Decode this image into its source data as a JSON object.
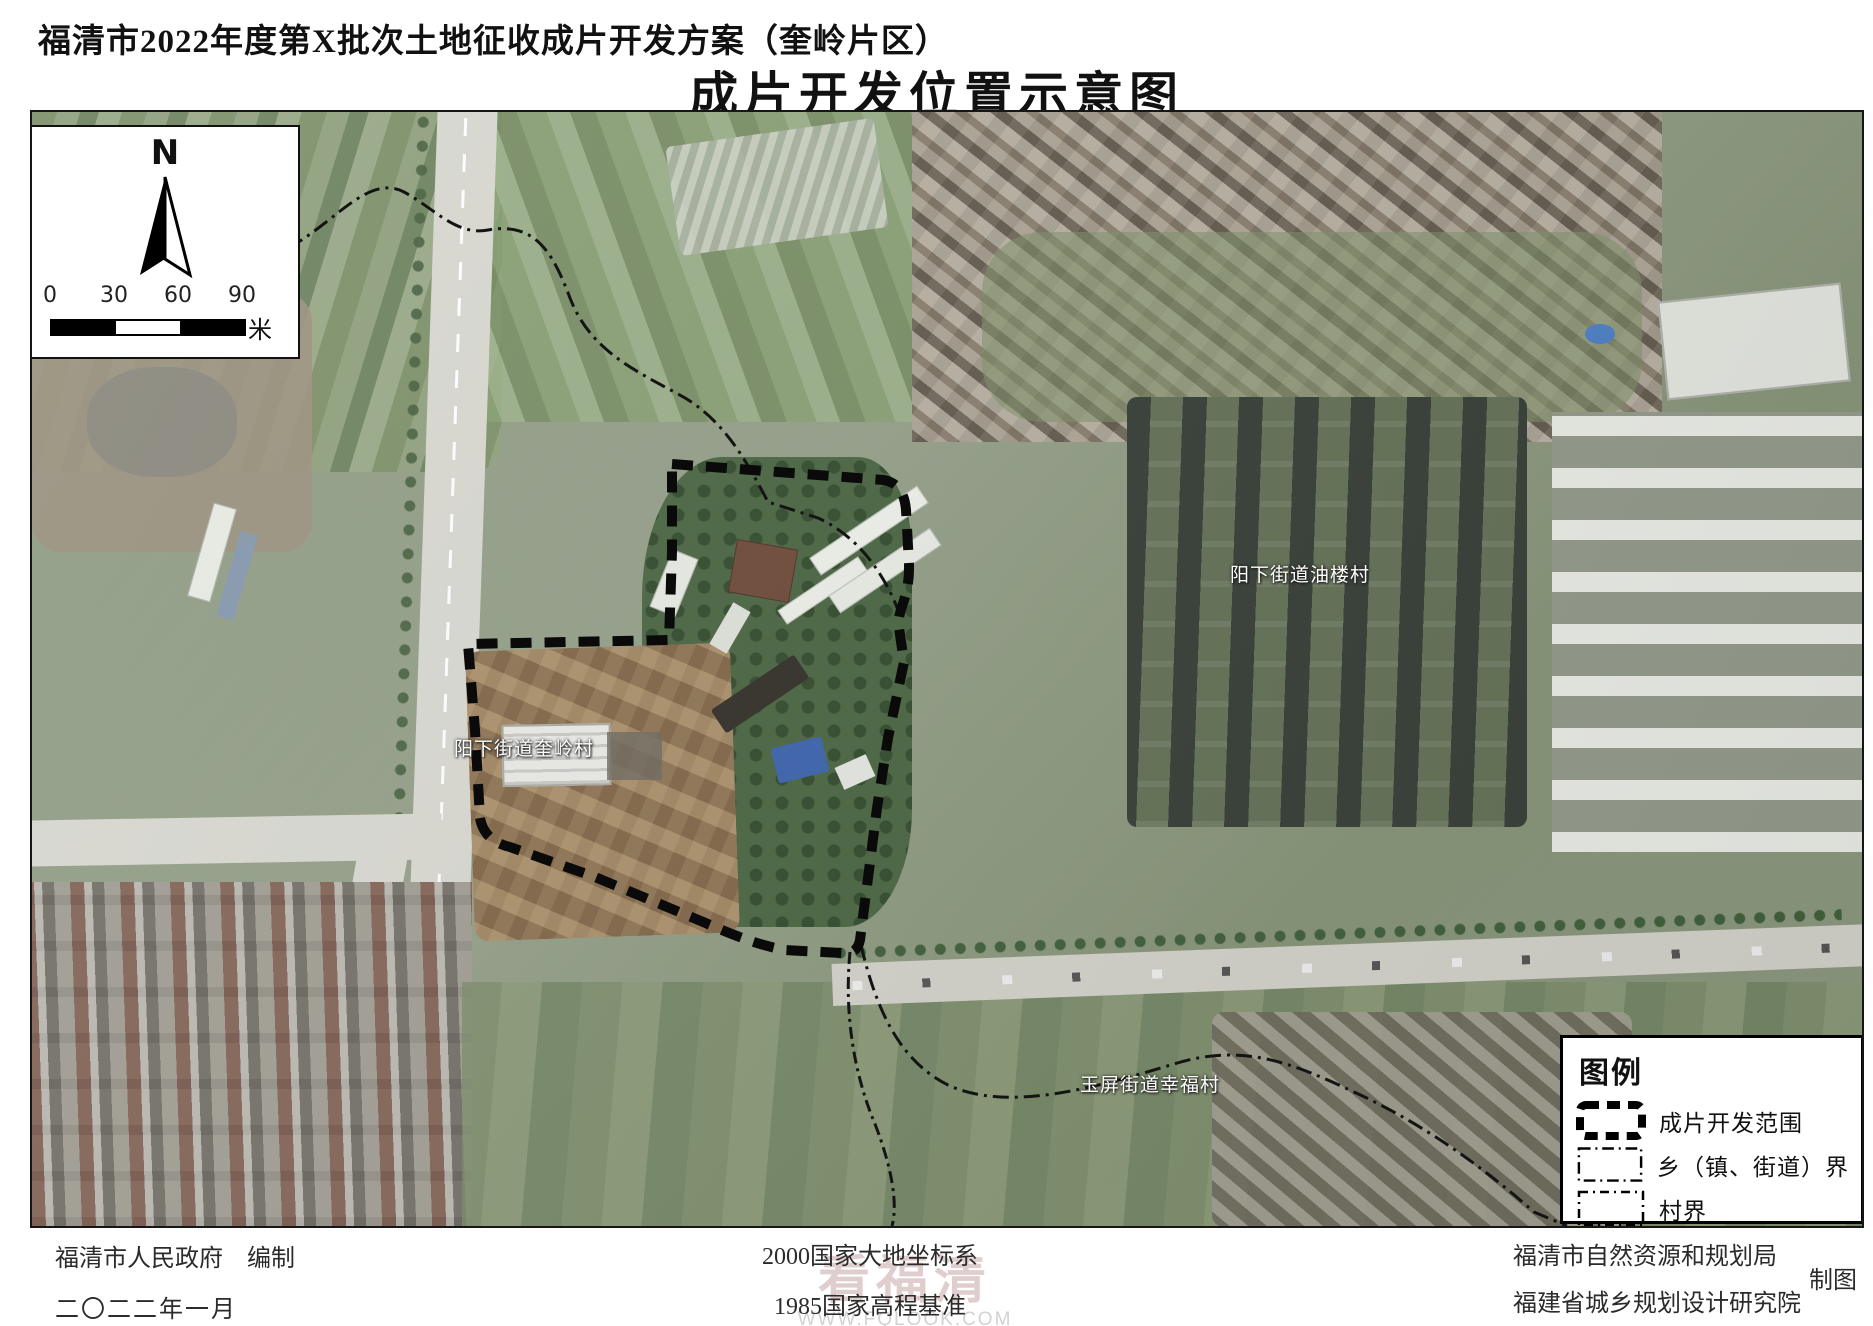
{
  "header": {
    "subtitle": "福清市2022年度第X批次土地征收成片开发方案（奎岭片区）",
    "title": "成片开发位置示意图"
  },
  "map": {
    "north_label": "N",
    "scale_bar": {
      "ticks": [
        "0",
        "30",
        "60",
        "90"
      ],
      "unit": "米"
    },
    "area_labels": [
      {
        "text": "阳下街道油楼村"
      },
      {
        "text": "阳下街道奎岭村"
      },
      {
        "text": "玉屏街道幸福村"
      }
    ]
  },
  "legend": {
    "title": "图例",
    "items": [
      {
        "label": "成片开发范围"
      },
      {
        "label": "乡（镇、街道）界"
      },
      {
        "label": "村界"
      }
    ]
  },
  "footer": {
    "left": {
      "line1": "福清市人民政府　编制",
      "line2": "二〇二二年一月"
    },
    "center": {
      "line1": "2000国家大地坐标系",
      "line2": "1985国家高程基准"
    },
    "right": {
      "line1": "福清市自然资源和规划局",
      "line2": "福建省城乡规划设计研究院",
      "credit": "制图"
    }
  },
  "watermark": {
    "brand": "看福清",
    "url": "WWW.FQLOOK.COM"
  },
  "colors": {
    "boundary": "#0a0a0a",
    "map_label_text": "#ffffff",
    "panel_background": "#ffffff",
    "watermark_brand": "#d9c3c3"
  }
}
